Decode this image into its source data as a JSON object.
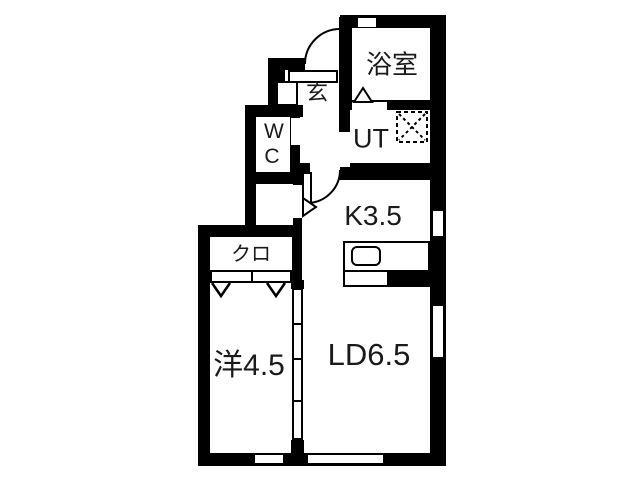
{
  "plan": {
    "type": "apartment-floor-plan",
    "wall_color": "#000000",
    "background_color": "#ffffff",
    "rooms": [
      {
        "id": "bathroom",
        "label": "浴室"
      },
      {
        "id": "utility",
        "label": "UT"
      },
      {
        "id": "entrance",
        "label": "玄"
      },
      {
        "id": "toilet",
        "label": "WC"
      },
      {
        "id": "kitchen",
        "label": "K3.5"
      },
      {
        "id": "closet",
        "label": "クロ"
      },
      {
        "id": "western-room",
        "label": "洋4.5"
      },
      {
        "id": "living-dining",
        "label": "LD6.5"
      }
    ],
    "fixtures": [
      "kitchen-counter",
      "kitchen-sink",
      "washing-machine-pan",
      "entrance-step",
      "shoe-cabinet",
      "closet-door-track",
      "closet-bifold-marks",
      "entrance-door-swing",
      "kitchen-door-swing",
      "bathroom-door-mark",
      "sliding-partition",
      "windows"
    ]
  }
}
